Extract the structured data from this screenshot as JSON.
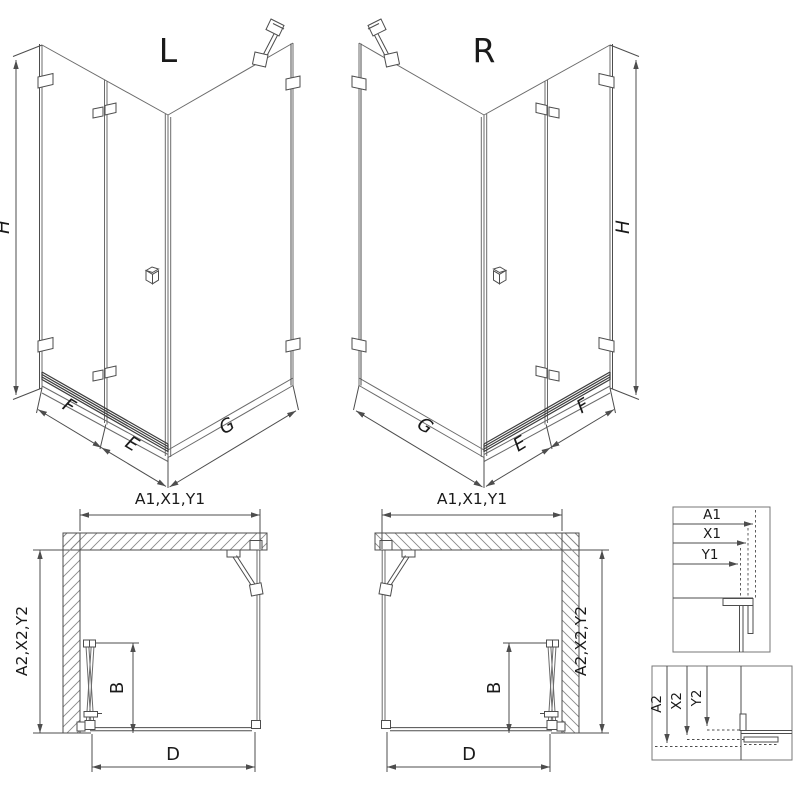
{
  "colors": {
    "line": "#4d4d4d",
    "glass": "#6b6b6b",
    "hatch": "#8a8a8a",
    "text": "#1a1a1a",
    "threshold": "#3f3f3f",
    "frame": "#777777",
    "background": "#ffffff"
  },
  "iso_left": {
    "variant_label": "L",
    "height": "H",
    "segment_fixed": "F",
    "segment_door": "E",
    "segment_side": "G"
  },
  "iso_right": {
    "variant_label": "R",
    "height": "H",
    "segment_fixed": "F",
    "segment_door": "E",
    "segment_side": "G"
  },
  "plan_left": {
    "width_dims": "A1,X1,Y1",
    "depth_dims": "A2,X2,Y2",
    "door_width": "B",
    "opening_width": "D"
  },
  "plan_right": {
    "width_dims": "A1,X1,Y1",
    "depth_dims": "A2,X2,Y2",
    "door_width": "B",
    "opening_width": "D"
  },
  "detail_width": {
    "dims": [
      "A1",
      "X1",
      "Y1"
    ]
  },
  "detail_depth": {
    "dims": [
      "A2",
      "X2",
      "Y2"
    ]
  }
}
